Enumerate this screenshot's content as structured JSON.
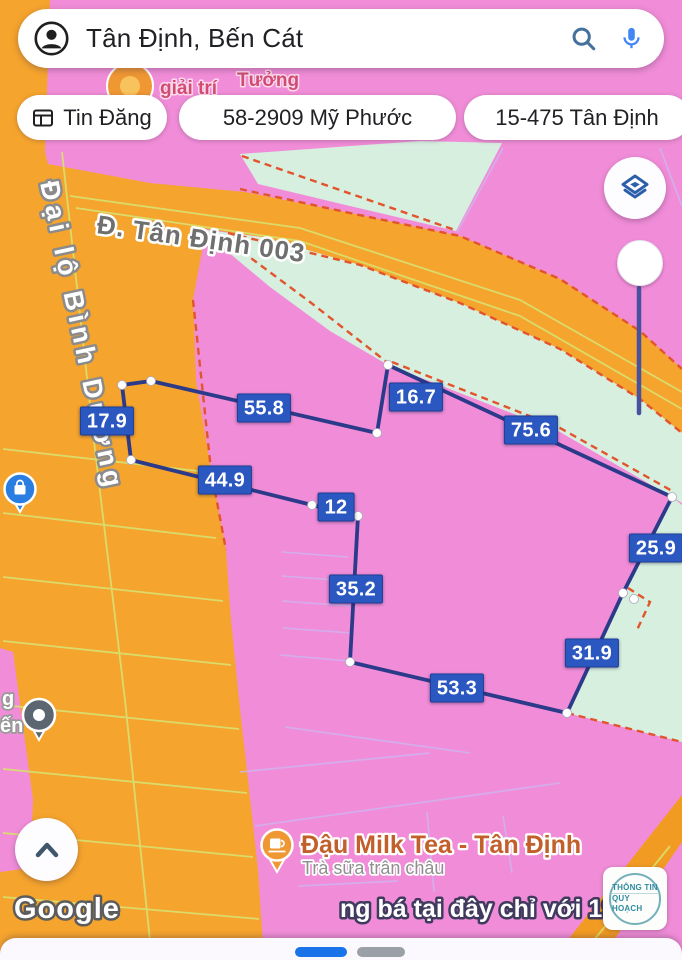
{
  "search": {
    "query": "Tân Định, Bến Cát"
  },
  "chips": {
    "c1": "Tin Đăng",
    "c2": "58-2909 Mỹ Phước",
    "c3": "15-475 Tân Định"
  },
  "roads": {
    "main_road": "Đại lộ Bình Dương",
    "side_road": "Đ. Tân Định 003"
  },
  "fragments": {
    "top_a": "giải trí",
    "top_b": "Tưởng",
    "left_a": "g",
    "left_b": "ến",
    "ad": "ng bá tại đây chỉ với 19k"
  },
  "poi": {
    "name": "Đậu Milk Tea - Tân Định",
    "subtitle": "Trà sữa trân châu"
  },
  "measurements": {
    "m1": "17.9",
    "m2": "55.8",
    "m3": "16.7",
    "m4": "75.6",
    "m5": "44.9",
    "m6": "12",
    "m7": "25.9",
    "m8": "35.2",
    "m9": "31.9",
    "m10": "53.3"
  },
  "branding": {
    "google": "Google",
    "stamp_line1": "THÔNG TIN",
    "stamp_line2": "QUY HOẠCH"
  },
  "colors": {
    "pink_zone": "#f18dd8",
    "orange_road": "#f5a42d",
    "teal_zone": "#d7efdf",
    "parcel_outline": "#2c3a8a",
    "measure_label_bg": "#2b57c0",
    "boundary_dash": "#e2542c",
    "accent_blue": "#4285F4"
  }
}
